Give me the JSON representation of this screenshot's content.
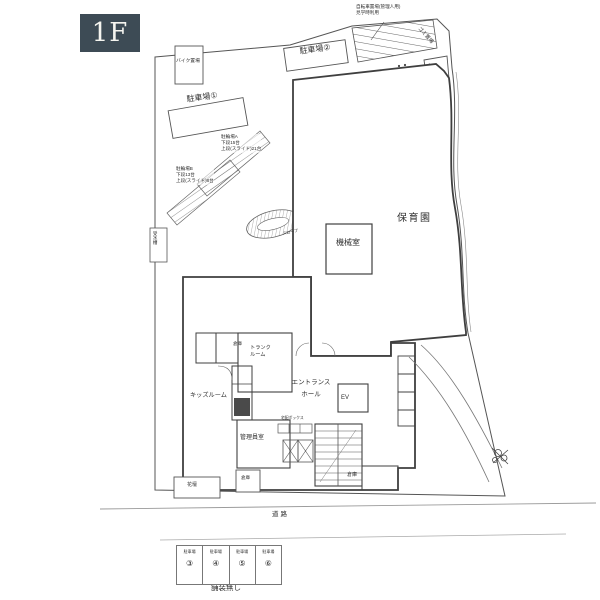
{
  "page": {
    "floor_badge": "1F"
  },
  "colors": {
    "bg": "#ffffff",
    "badge_bg": "#3d4b55",
    "badge_fg": "#f5f5f0",
    "label": "#2e2e2e",
    "wall": "#3f3f3f",
    "line": "#555555",
    "road": "#9a9a9a"
  },
  "labels": [
    {
      "name": "note-top",
      "text": "自転車置場(管理人用)\n見学時利用",
      "x": 356,
      "y": 4,
      "size": 4.6
    },
    {
      "name": "gomi-okiba",
      "text": "ゴミ置場",
      "x": 421,
      "y": 26,
      "size": 5,
      "rotate": 48
    },
    {
      "name": "parking-2",
      "text": "駐車場②",
      "x": 299,
      "y": 47,
      "size": 8,
      "rotate": -8
    },
    {
      "name": "bike-storage",
      "text": "バイク置場",
      "x": 176,
      "y": 59,
      "size": 4.8
    },
    {
      "name": "parking-1",
      "text": "駐車場①",
      "x": 186,
      "y": 95,
      "size": 8,
      "rotate": -8
    },
    {
      "name": "bike-rack-a",
      "text": "駐輪場A\n下段15台\n上段(スライド)21台",
      "x": 221,
      "y": 134,
      "size": 4.6,
      "bg": true
    },
    {
      "name": "bike-rack-b",
      "text": "駐輪場B\n下段13台\n上段(スライド)8台",
      "x": 176,
      "y": 166,
      "size": 4.6,
      "bg": true
    },
    {
      "name": "water-tank",
      "text": "受水槽",
      "x": 152,
      "y": 231,
      "size": 4.5,
      "vertical": true
    },
    {
      "name": "slope",
      "text": "スロープ",
      "x": 282,
      "y": 231,
      "size": 4,
      "rotate": -12
    },
    {
      "name": "nursery",
      "text": "保育園",
      "x": 397,
      "y": 212,
      "size": 10,
      "ls": 1.5
    },
    {
      "name": "machine-room",
      "text": "機械室",
      "x": 336,
      "y": 238,
      "size": 8
    },
    {
      "name": "storage-1",
      "text": "倉庫",
      "x": 233,
      "y": 341,
      "size": 4.5
    },
    {
      "name": "trunk-room",
      "text": "トランク\nルーム",
      "x": 250,
      "y": 345,
      "size": 5.2
    },
    {
      "name": "kids-room",
      "text": "キッズルーム",
      "x": 190,
      "y": 392,
      "size": 6.2
    },
    {
      "name": "entrance-hall",
      "text": "エントランス\nホール",
      "x": 289,
      "y": 377,
      "size": 6.5,
      "lh": 1.9,
      "align": "center",
      "w": 44
    },
    {
      "name": "ev",
      "text": "EV",
      "x": 341,
      "y": 394,
      "size": 6
    },
    {
      "name": "delivery-box",
      "text": "宅配ボックス",
      "x": 281,
      "y": 416,
      "size": 3.8
    },
    {
      "name": "manager-room",
      "text": "管理員室",
      "x": 240,
      "y": 434,
      "size": 6
    },
    {
      "name": "storage-2",
      "text": "倉庫",
      "x": 347,
      "y": 472,
      "size": 5
    },
    {
      "name": "storage-3",
      "text": "倉庫",
      "x": 241,
      "y": 475,
      "size": 4.5
    },
    {
      "name": "flower-bed",
      "text": "花壇",
      "x": 187,
      "y": 482,
      "size": 5
    },
    {
      "name": "road",
      "text": "道路",
      "x": 272,
      "y": 511,
      "size": 6.5,
      "ls": 2
    },
    {
      "name": "no-pavement",
      "text": "舗装無し",
      "x": 211,
      "y": 583,
      "size": 7.5
    }
  ],
  "parking": {
    "stalls": [
      {
        "label": "駐車場",
        "number": "③"
      },
      {
        "label": "駐車場",
        "number": "④"
      },
      {
        "label": "駐車場",
        "number": "⑤"
      },
      {
        "label": "駐車場",
        "number": "⑥"
      }
    ]
  }
}
